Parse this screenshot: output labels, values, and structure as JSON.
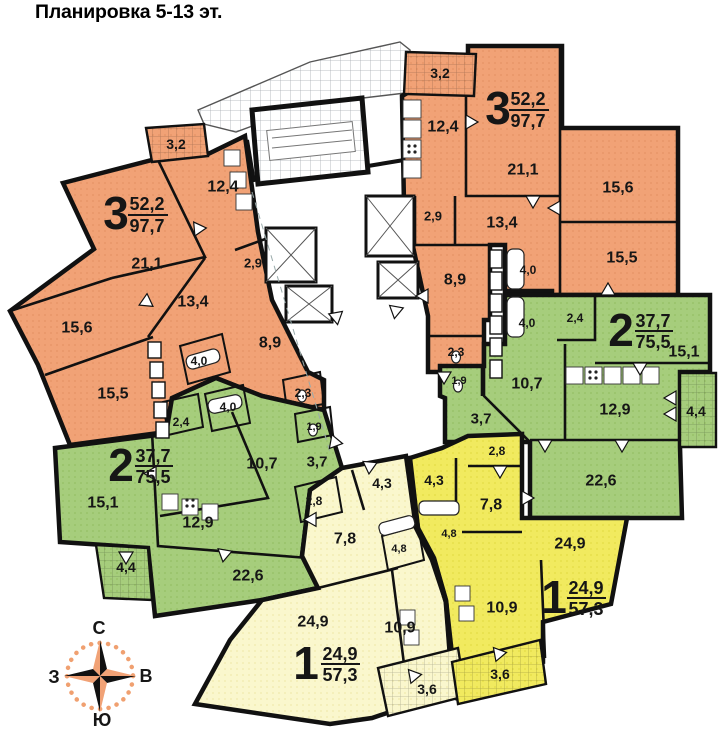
{
  "title": "Планировка 5-13 эт.",
  "colors": {
    "orange": "#F1A276",
    "green": "#A6CD7C",
    "yellow_bright": "#F1EA5F",
    "yellow_pale": "#FAF7CD",
    "wall": "#111111",
    "compass_accent": "#F0A070"
  },
  "compass": {
    "points": [
      {
        "t": "С",
        "x": 99,
        "y": 628
      },
      {
        "t": "Ю",
        "x": 102,
        "y": 720
      },
      {
        "t": "З",
        "x": 54,
        "y": 677
      },
      {
        "t": "В",
        "x": 146,
        "y": 676
      }
    ]
  },
  "apartments": [
    {
      "name": "3-room-left",
      "type": "3",
      "area_living": "52,2",
      "area_total": "97,7",
      "label": {
        "big": "3",
        "bx": 116,
        "by": 213,
        "num": "52,2",
        "nx": 147,
        "ny": 204,
        "den": "97,7",
        "dx": 147,
        "dy": 226,
        "lx1": 128,
        "lx2": 168,
        "ly": 215
      },
      "rooms": [
        {
          "t": "3,2",
          "x": 176,
          "y": 144,
          "s": 14
        },
        {
          "t": "12,4",
          "x": 223,
          "y": 187,
          "s": 16
        },
        {
          "t": "21,1",
          "x": 147,
          "y": 264,
          "s": 16
        },
        {
          "t": "13,4",
          "x": 193,
          "y": 302,
          "s": 16
        },
        {
          "t": "15,6",
          "x": 77,
          "y": 328,
          "s": 16
        },
        {
          "t": "15,5",
          "x": 113,
          "y": 394,
          "s": 16
        },
        {
          "t": "8,9",
          "x": 270,
          "y": 343,
          "s": 16
        },
        {
          "t": "2,9",
          "x": 253,
          "y": 263,
          "s": 13
        },
        {
          "t": "4,0",
          "x": 199,
          "y": 361,
          "s": 12
        },
        {
          "t": "2,3",
          "x": 303,
          "y": 393,
          "s": 12
        }
      ]
    },
    {
      "name": "3-room-right",
      "type": "3",
      "area_living": "52,2",
      "area_total": "97,7",
      "label": {
        "big": "3",
        "bx": 498,
        "by": 108,
        "num": "52,2",
        "nx": 528,
        "ny": 99,
        "den": "97,7",
        "dx": 528,
        "dy": 121,
        "lx1": 509,
        "lx2": 549,
        "ly": 110
      },
      "rooms": [
        {
          "t": "3,2",
          "x": 440,
          "y": 73,
          "s": 14
        },
        {
          "t": "12,4",
          "x": 443,
          "y": 127,
          "s": 16
        },
        {
          "t": "21,1",
          "x": 523,
          "y": 170,
          "s": 16
        },
        {
          "t": "13,4",
          "x": 502,
          "y": 223,
          "s": 16
        },
        {
          "t": "15,6",
          "x": 618,
          "y": 188,
          "s": 16
        },
        {
          "t": "15,5",
          "x": 622,
          "y": 258,
          "s": 16
        },
        {
          "t": "8,9",
          "x": 455,
          "y": 280,
          "s": 16
        },
        {
          "t": "2,9",
          "x": 433,
          "y": 216,
          "s": 13
        },
        {
          "t": "4,0",
          "x": 528,
          "y": 270,
          "s": 12
        },
        {
          "t": "2,3",
          "x": 456,
          "y": 352,
          "s": 12
        }
      ]
    },
    {
      "name": "2-room-left",
      "type": "2",
      "area_living": "37,7",
      "area_total": "75,5",
      "label": {
        "big": "2",
        "bx": 121,
        "by": 465,
        "num": "37,7",
        "nx": 153,
        "ny": 456,
        "den": "75,5",
        "dx": 153,
        "dy": 477,
        "lx1": 135,
        "lx2": 173,
        "ly": 466
      },
      "rooms": [
        {
          "t": "2,4",
          "x": 181,
          "y": 422,
          "s": 12
        },
        {
          "t": "4,0",
          "x": 228,
          "y": 407,
          "s": 12
        },
        {
          "t": "1,9",
          "x": 314,
          "y": 427,
          "s": 11
        },
        {
          "t": "15,1",
          "x": 103,
          "y": 503,
          "s": 16
        },
        {
          "t": "10,7",
          "x": 262,
          "y": 464,
          "s": 16
        },
        {
          "t": "3,7",
          "x": 317,
          "y": 462,
          "s": 15
        },
        {
          "t": "12,9",
          "x": 198,
          "y": 523,
          "s": 16
        },
        {
          "t": "22,6",
          "x": 248,
          "y": 576,
          "s": 16
        },
        {
          "t": "4,4",
          "x": 126,
          "y": 567,
          "s": 14
        }
      ]
    },
    {
      "name": "2-room-right",
      "type": "2",
      "area_living": "37,7",
      "area_total": "75,5",
      "label": {
        "big": "2",
        "bx": 621,
        "by": 330,
        "num": "37,7",
        "nx": 653,
        "ny": 321,
        "den": "75,5",
        "dx": 653,
        "dy": 342,
        "lx1": 635,
        "lx2": 673,
        "ly": 331
      },
      "rooms": [
        {
          "t": "2,4",
          "x": 575,
          "y": 318,
          "s": 12
        },
        {
          "t": "4,0",
          "x": 527,
          "y": 323,
          "s": 12
        },
        {
          "t": "1,9",
          "x": 459,
          "y": 381,
          "s": 11
        },
        {
          "t": "15,1",
          "x": 684,
          "y": 352,
          "s": 16
        },
        {
          "t": "10,7",
          "x": 527,
          "y": 384,
          "s": 16
        },
        {
          "t": "3,7",
          "x": 481,
          "y": 419,
          "s": 15
        },
        {
          "t": "12,9",
          "x": 615,
          "y": 410,
          "s": 16
        },
        {
          "t": "22,6",
          "x": 601,
          "y": 481,
          "s": 16
        },
        {
          "t": "4,4",
          "x": 696,
          "y": 411,
          "s": 14
        }
      ]
    },
    {
      "name": "1-room-left",
      "type": "1",
      "area_living": "24,9",
      "area_total": "57,3",
      "label": {
        "big": "1",
        "bx": 306,
        "by": 663,
        "num": "24,9",
        "nx": 340,
        "ny": 654,
        "den": "57,3",
        "dx": 340,
        "dy": 675,
        "lx1": 321,
        "lx2": 360,
        "ly": 664
      },
      "rooms": [
        {
          "t": "2,8",
          "x": 314,
          "y": 501,
          "s": 12
        },
        {
          "t": "4,3",
          "x": 382,
          "y": 483,
          "s": 14
        },
        {
          "t": "7,8",
          "x": 345,
          "y": 539,
          "s": 16
        },
        {
          "t": "4,8",
          "x": 399,
          "y": 549,
          "s": 11
        },
        {
          "t": "24,9",
          "x": 313,
          "y": 622,
          "s": 16
        },
        {
          "t": "10,9",
          "x": 400,
          "y": 628,
          "s": 16
        },
        {
          "t": "3,6",
          "x": 427,
          "y": 689,
          "s": 14
        }
      ]
    },
    {
      "name": "1-room-right",
      "type": "1",
      "area_living": "24,9",
      "area_total": "57,3",
      "label": {
        "big": "1",
        "bx": 554,
        "by": 597,
        "num": "24,9",
        "nx": 586,
        "ny": 588,
        "den": "57,3",
        "dx": 586,
        "dy": 609,
        "lx1": 567,
        "lx2": 606,
        "ly": 598
      },
      "rooms": [
        {
          "t": "2,8",
          "x": 497,
          "y": 451,
          "s": 12
        },
        {
          "t": "4,3",
          "x": 434,
          "y": 480,
          "s": 14
        },
        {
          "t": "7,8",
          "x": 491,
          "y": 505,
          "s": 16
        },
        {
          "t": "4,8",
          "x": 449,
          "y": 534,
          "s": 11
        },
        {
          "t": "24,9",
          "x": 570,
          "y": 544,
          "s": 16
        },
        {
          "t": "10,9",
          "x": 502,
          "y": 608,
          "s": 16
        },
        {
          "t": "3,6",
          "x": 500,
          "y": 674,
          "s": 14
        }
      ]
    }
  ]
}
